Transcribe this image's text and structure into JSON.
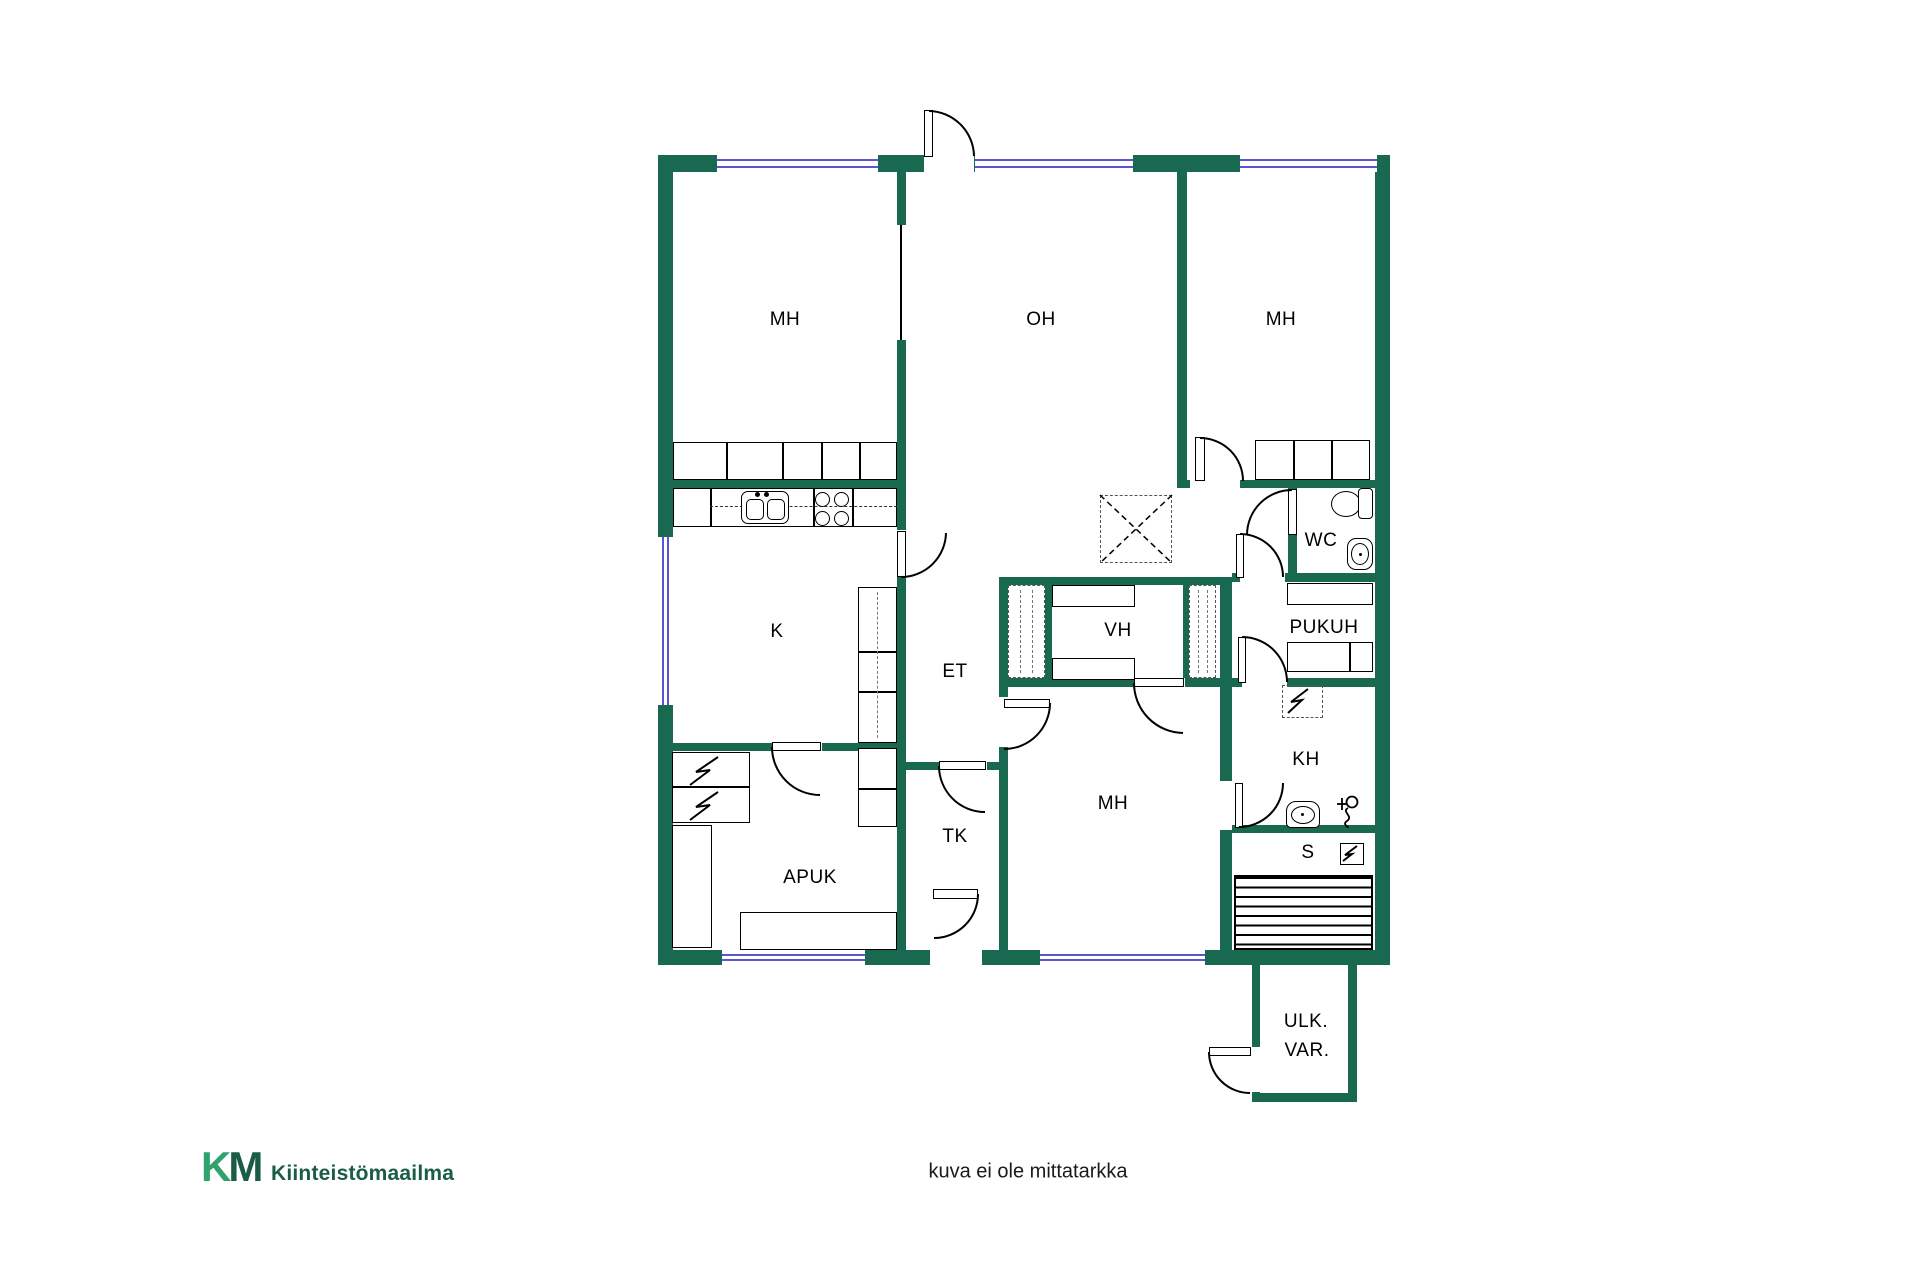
{
  "labels": {
    "mh_top_left": "MH",
    "oh": "OH",
    "mh_top_right": "MH",
    "wc": "WC",
    "k": "K",
    "et": "ET",
    "vh": "VH",
    "pukuh": "PUKUH",
    "kh": "KH",
    "s": "S",
    "tk": "TK",
    "mh_bottom": "MH",
    "apuk": "APUK",
    "ulk_line1": "ULK.",
    "ulk_line2": "VAR."
  },
  "footer": {
    "logo_k": "K",
    "logo_m": "M",
    "brand": "Kiinteistömaailma",
    "disclaimer": "kuva ei ole mittatarkka"
  },
  "colors": {
    "wall": "#186950",
    "window": "#5B55D6",
    "logo_green_light": "#2FA26D",
    "logo_green_dark": "#1A5C45",
    "text": "#000000"
  }
}
